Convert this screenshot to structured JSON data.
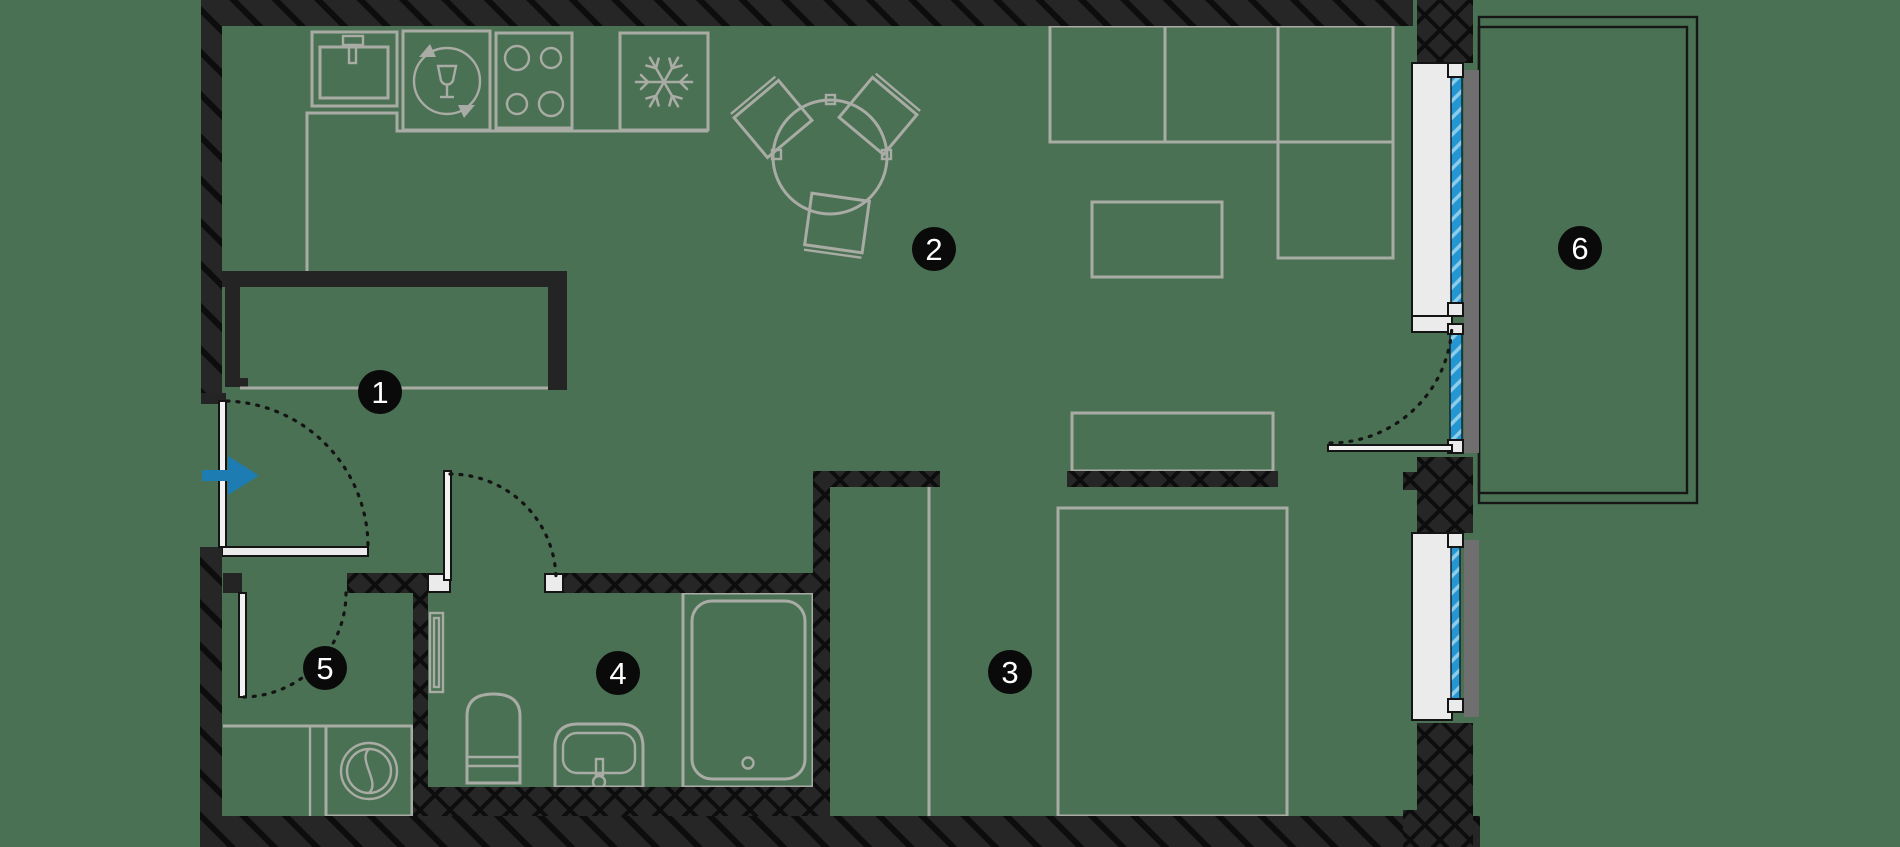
{
  "meta": {
    "title": "Apartment floor plan"
  },
  "colors": {
    "floor": "#4a7153",
    "wall": "#262626",
    "wall_hatch": "#0d0d0d",
    "furniture_line": "#a9aba5",
    "thin_outline": "#161616",
    "window_frame_white": "#ebebeb",
    "window_frame_gray": "#6f6f6f",
    "glazing_blue": "#2496d2",
    "glazing_hatch": "#8ecdea",
    "entrance_arrow_blue": "#1d7db3",
    "badge_background": "#0a0a0a",
    "badge_text": "#ffffff"
  },
  "rooms": [
    {
      "number": "1"
    },
    {
      "number": "2"
    },
    {
      "number": "3"
    },
    {
      "number": "4"
    },
    {
      "number": "5"
    },
    {
      "number": "6"
    }
  ],
  "icons": {
    "kitchen_sink": "sink-icon",
    "dishwasher": "wine-glass-recycle-icon",
    "cooktop": "four-burner-stove-icon",
    "refrigerator": "snowflake-icon",
    "washing_machine": "washer-drum-icon",
    "entrance": "arrow-right-icon"
  }
}
